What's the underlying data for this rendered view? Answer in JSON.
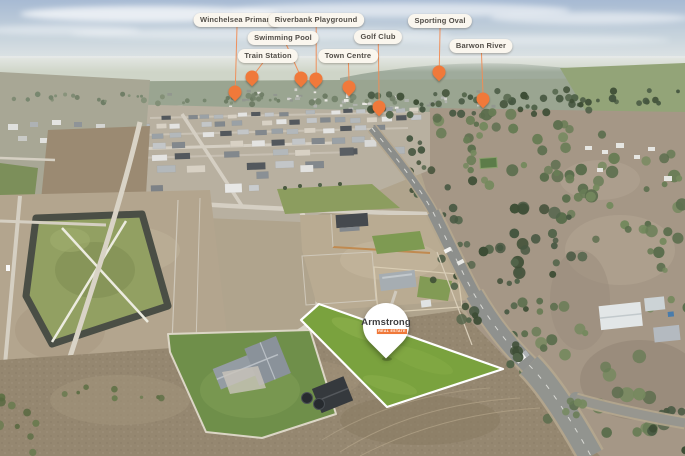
{
  "colors": {
    "pin_orange": "#f0793a",
    "connector_orange": "#f08c55",
    "pill_bg": "#faf6ee",
    "pill_text": "#524e48",
    "lot_green": "#7aa23e",
    "lot_outline": "#ffffff",
    "balloon_bg": "#ffffff",
    "brand_text": "#3e3e40"
  },
  "markers": [
    {
      "id": "winchelsea-primary",
      "label": "Winchelsea Primary",
      "pill": [
        237,
        20
      ],
      "pin": [
        235,
        92
      ]
    },
    {
      "id": "riverbank-playground",
      "label": "Riverbank Playground",
      "pill": [
        316,
        20
      ],
      "pin": [
        316,
        79
      ]
    },
    {
      "id": "sporting-oval",
      "label": "Sporting Oval",
      "pill": [
        440,
        21
      ],
      "pin": [
        439,
        72
      ]
    },
    {
      "id": "swimming-pool",
      "label": "Swimming Pool",
      "pill": [
        283,
        38
      ],
      "pin": [
        301,
        78
      ]
    },
    {
      "id": "golf-club",
      "label": "Golf Club",
      "pill": [
        378,
        37
      ],
      "pin": [
        379,
        107
      ]
    },
    {
      "id": "barwon-river",
      "label": "Barwon River",
      "pill": [
        481,
        46
      ],
      "pin": [
        483,
        99
      ]
    },
    {
      "id": "train-station",
      "label": "Train Station",
      "pill": [
        268,
        56
      ],
      "pin": [
        252,
        77
      ]
    },
    {
      "id": "town-centre",
      "label": "Town Centre",
      "pill": [
        348,
        56
      ],
      "pin": [
        349,
        87
      ]
    }
  ],
  "lot_marker": {
    "brand": "Armstrong",
    "tag": "REAL ESTATE",
    "x": 386,
    "y": 358
  }
}
